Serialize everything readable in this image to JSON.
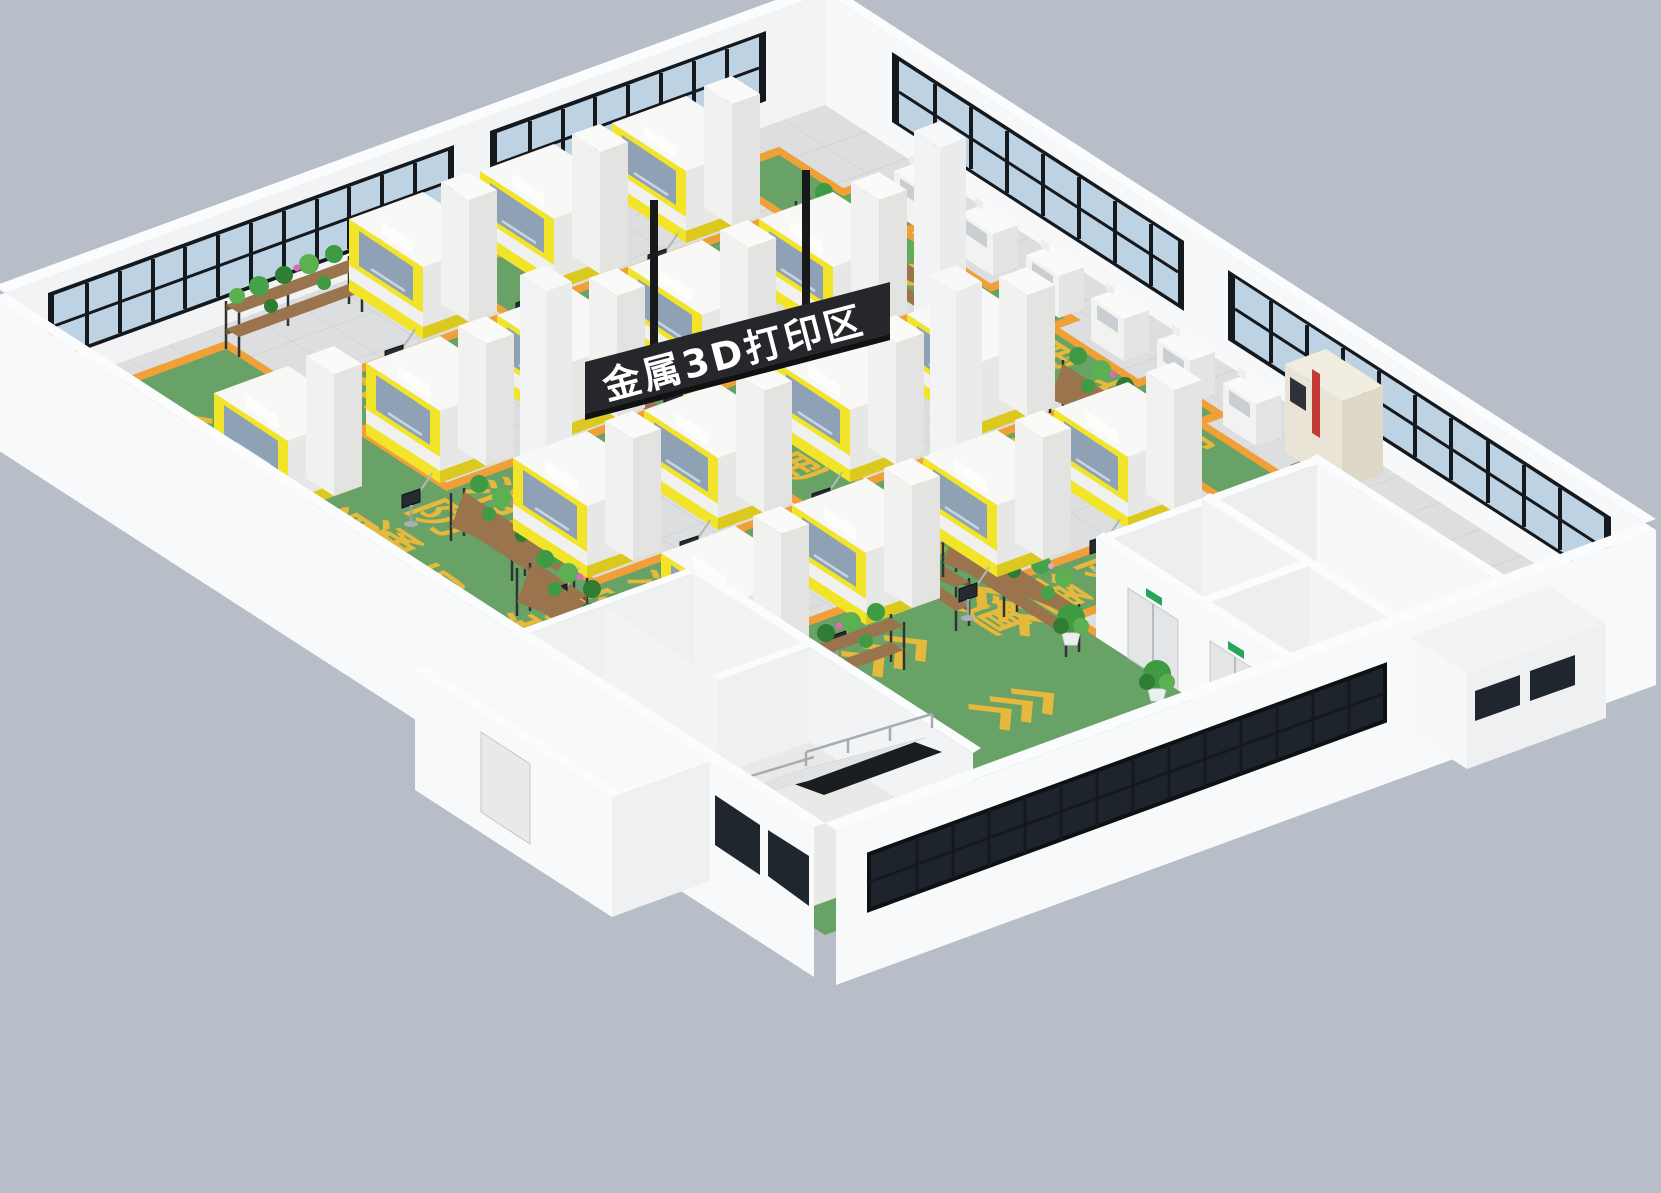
{
  "scene": {
    "sign": {
      "text": "金属3D打印区",
      "bg": "#26272a",
      "text_color": "#ffffff",
      "post_color": "#17181a"
    },
    "floor": {
      "lane_label": "消防通道",
      "chars": [
        "消",
        "防",
        "通",
        "道"
      ],
      "chevron": "<<<",
      "lane_color": "#69a266",
      "lane_border_color": "#f0a037",
      "lane_text_color": "#e6b83c",
      "tile_color": "#dcdedf",
      "grid_color": "#c9cbcd"
    },
    "palette": {
      "background": "#b7bec8",
      "wall_light": "#f6f8f9",
      "wall_shade": "#f1f3f4",
      "window_glass": "#bdd2e2",
      "window_glass_dark": "#1e242c",
      "window_frame": "#15181c",
      "machine_body": "#f0f0ee",
      "machine_accent": "#f2e428",
      "machine_window": "#8fa2b5",
      "cnc_body": "#e9e4d6",
      "cnc_accent": "#c43b35",
      "plant_green": "#3f9b43",
      "plant_flower": "#d66fb0",
      "rack_wood": "#9a744d",
      "rack_frame": "#2f3336",
      "exit_sign": "#27a65a"
    },
    "counts": {
      "large_printers": 16,
      "small_printers": 6,
      "plant_racks": 12,
      "columns": 3,
      "potted_plants": 2,
      "staircases": 2
    }
  }
}
